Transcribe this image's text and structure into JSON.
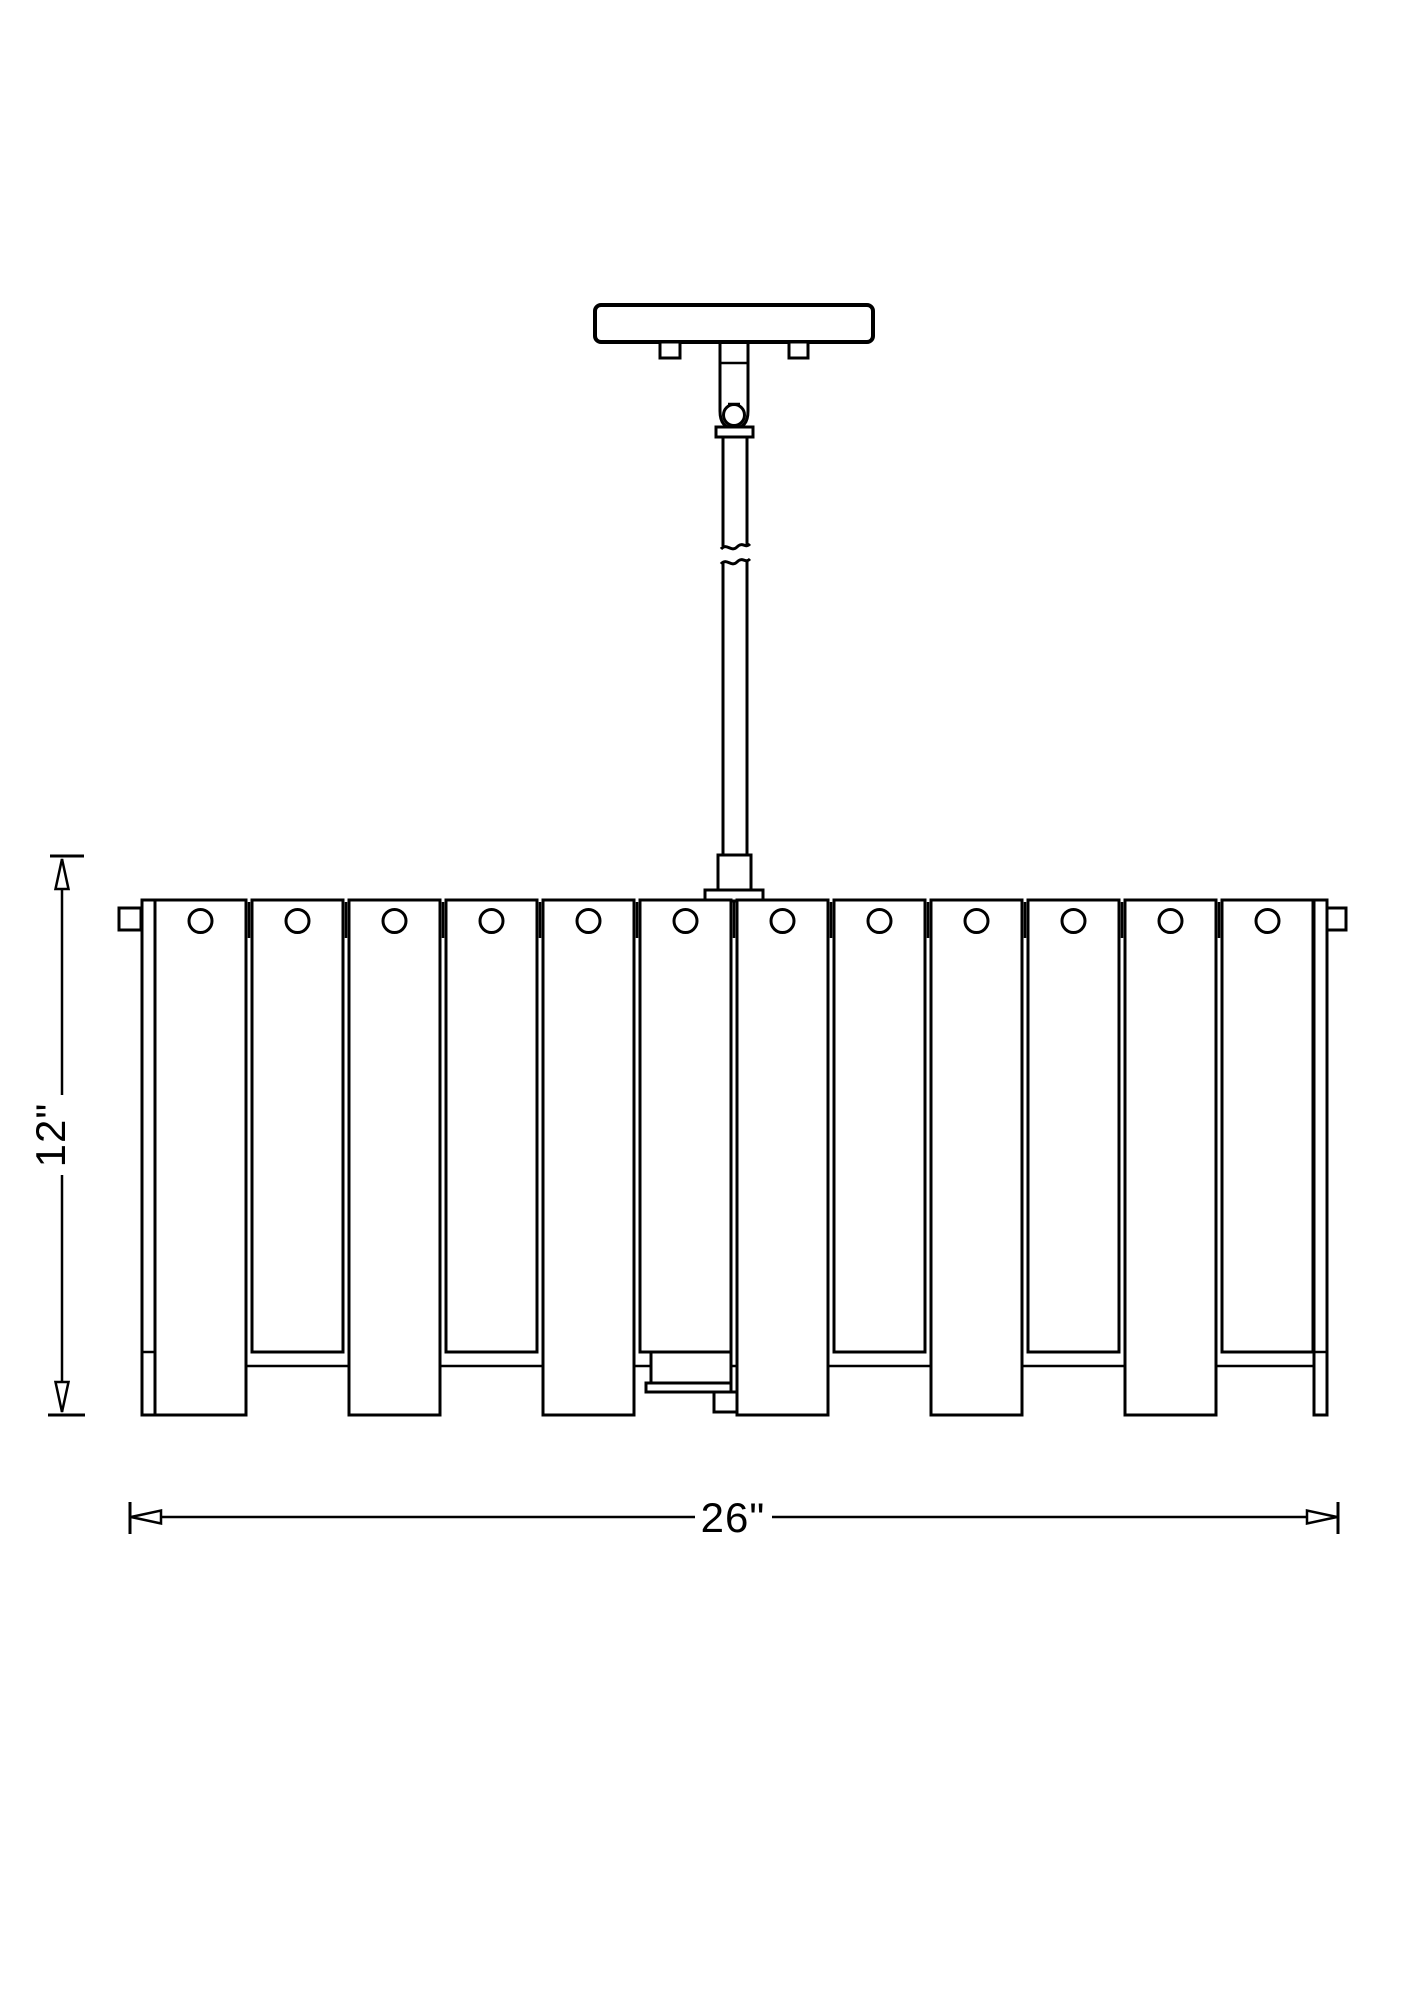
{
  "drawing": {
    "subject": "Drum chandelier with vertical slat shade - front elevation dimension drawing",
    "background_color": "#ffffff",
    "line_color": "#000000"
  },
  "dimensions": {
    "height_label": "12\"",
    "width_label": "26\""
  },
  "fixture": {
    "canopy": "ceiling canopy with two mounting screws",
    "downrod": "two-section downrod with break symbol and hang-straight ball swivel",
    "shade": {
      "slat_count": 12,
      "holes_per_slat": 1,
      "alternating_lengths": true
    }
  }
}
